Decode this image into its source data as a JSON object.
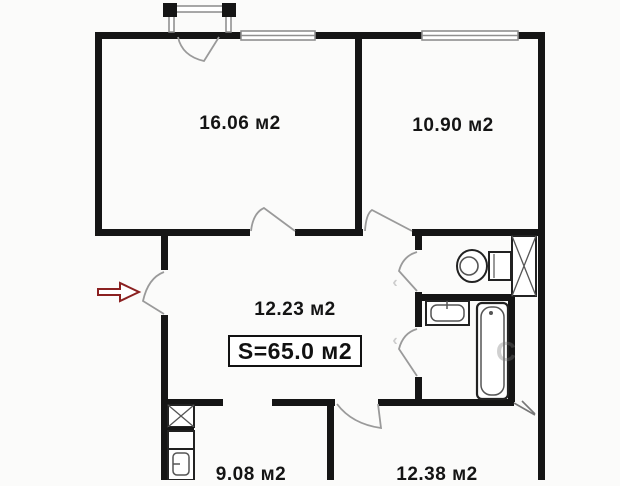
{
  "plan_type": "apartment-floor-plan",
  "rooms": [
    {
      "name": "room-top-left",
      "area_label": "16.06 м2"
    },
    {
      "name": "room-top-right",
      "area_label": "10.90 м2"
    },
    {
      "name": "hallway",
      "area_label": "12.23 м2"
    },
    {
      "name": "room-bottom-left",
      "area_label": "9.08 м2"
    },
    {
      "name": "room-bottom-right",
      "area_label": "12.38 м2"
    }
  ],
  "total_area": {
    "label": "S=65.0 м2"
  },
  "entrance": {
    "symbol": "red-outline-arrow",
    "direction": "right"
  },
  "fixtures": [
    "toilet",
    "bathtub",
    "wash-sink",
    "kitchen-sink",
    "vent-shaft",
    "kitchen-vent-shaft"
  ],
  "watermark": {
    "mark_1": "‹",
    "mark_2": "‹",
    "letter": "С"
  },
  "colors": {
    "wall": "#151515",
    "door_swing": "#9a9a9a",
    "window": "#8f8f8f",
    "entrance_arrow": "#8b2121",
    "background": "#fbfbfa"
  }
}
